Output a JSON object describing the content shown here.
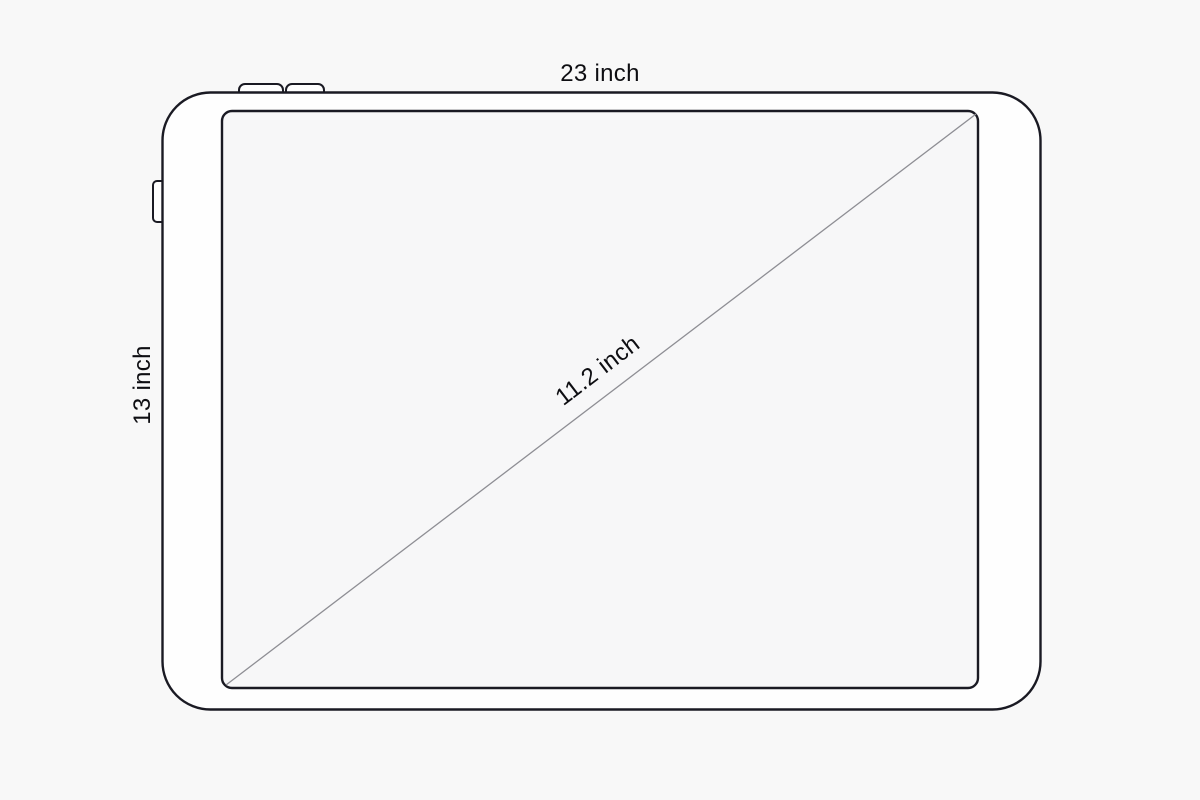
{
  "diagram": {
    "labels": {
      "width": "23 inch",
      "height": "13 inch",
      "diagonal": "11.2 inch"
    },
    "colors": {
      "background": "#f8f8f8",
      "body_fill": "#fefefe",
      "screen_fill": "#f7f7f8",
      "outline": "#1a1a23",
      "diagonal_line": "#8e8e94",
      "text": "#0e0e12"
    }
  }
}
